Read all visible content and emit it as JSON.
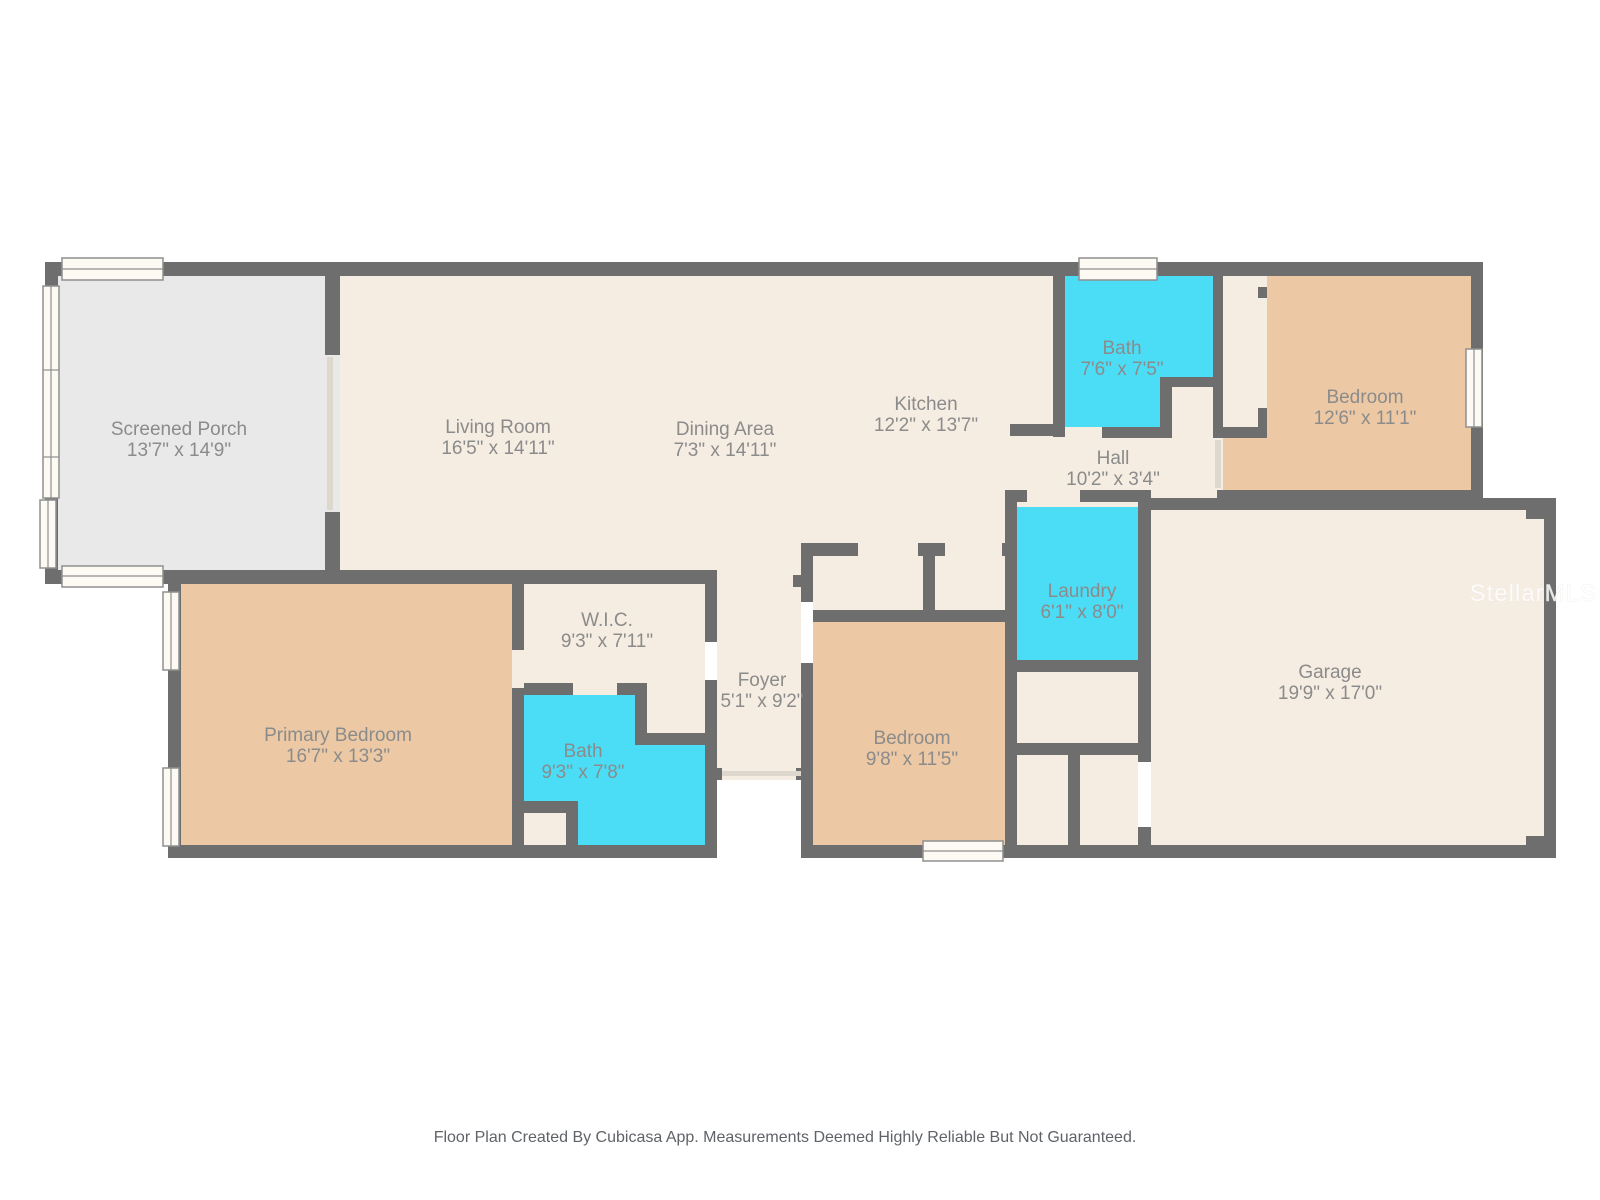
{
  "footer": "Floor Plan Created By Cubicasa App. Measurements Deemed Highly Reliable But Not Guaranteed.",
  "watermark": "StellarMLS",
  "colors": {
    "wall": "#6e6e6e",
    "floor": "#f6ede2",
    "bedroom_floor": "#ecc9a4",
    "wet_room_floor": "#4bddf6",
    "porch_floor": "#e9e9e9",
    "label_text": "#8b8b8b",
    "footer_text": "#5f6368"
  },
  "rooms": [
    {
      "id": "screened-porch",
      "name": "Screened Porch",
      "dims": "13'7\" x 14'9\""
    },
    {
      "id": "living-room",
      "name": "Living Room",
      "dims": "16'5\" x 14'11\""
    },
    {
      "id": "dining-area",
      "name": "Dining Area",
      "dims": "7'3\" x 14'11\""
    },
    {
      "id": "kitchen",
      "name": "Kitchen",
      "dims": "12'2\" x 13'7\""
    },
    {
      "id": "bath-upper",
      "name": "Bath",
      "dims": "7'6\" x 7'5\""
    },
    {
      "id": "bedroom-upper",
      "name": "Bedroom",
      "dims": "12'6\" x 11'1\""
    },
    {
      "id": "hall",
      "name": "Hall",
      "dims": "10'2\" x 3'4\""
    },
    {
      "id": "laundry",
      "name": "Laundry",
      "dims": "6'1\" x 8'0\""
    },
    {
      "id": "garage",
      "name": "Garage",
      "dims": "19'9\" x 17'0\""
    },
    {
      "id": "primary-bedroom",
      "name": "Primary Bedroom",
      "dims": "16'7\" x 13'3\""
    },
    {
      "id": "wic",
      "name": "W.I.C.",
      "dims": "9'3\" x 7'11\""
    },
    {
      "id": "bath-primary",
      "name": "Bath",
      "dims": "9'3\" x 7'8\""
    },
    {
      "id": "foyer",
      "name": "Foyer",
      "dims": "5'1\" x 9'2\""
    },
    {
      "id": "bedroom-middle",
      "name": "Bedroom",
      "dims": "9'8\" x 11'5\""
    }
  ]
}
